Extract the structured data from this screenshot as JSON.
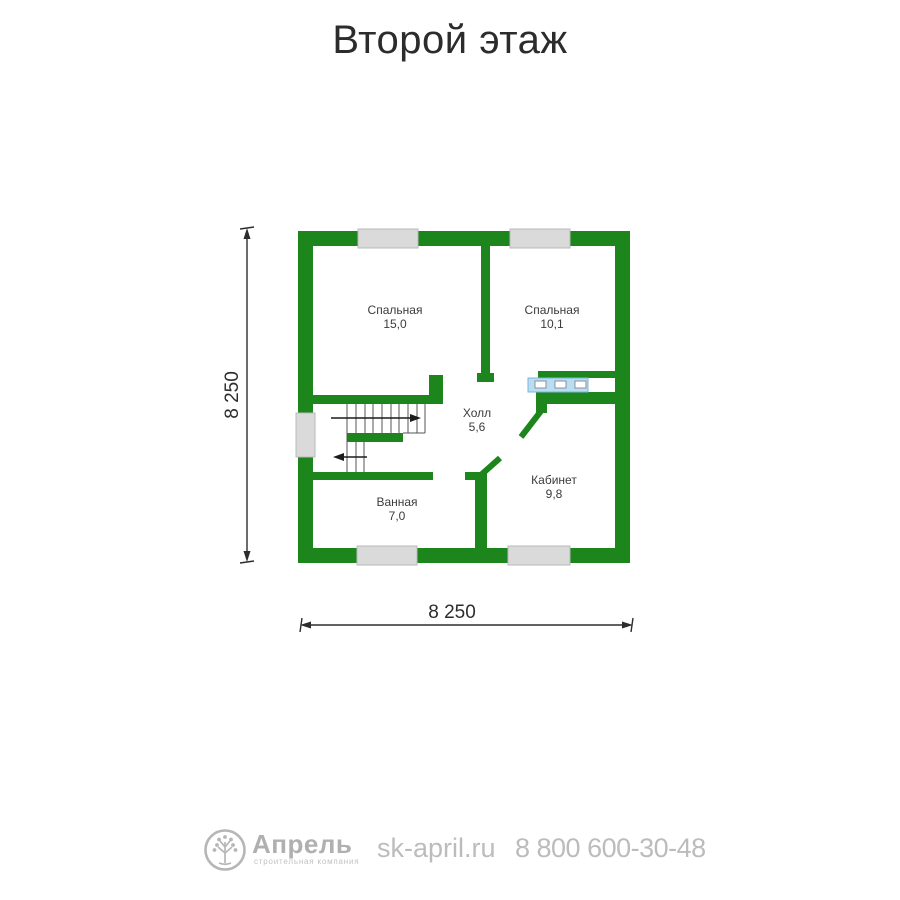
{
  "title": "Второй этаж",
  "plan": {
    "rooms": [
      {
        "name": "Спальная",
        "area": "15,0"
      },
      {
        "name": "Спальная",
        "area": "10,1"
      },
      {
        "name": "Холл",
        "area": "5,6"
      },
      {
        "name": "Кабинет",
        "area": "9,8"
      },
      {
        "name": "Ванная",
        "area": "7,0"
      }
    ],
    "dimensions": {
      "width_label": "8 250",
      "height_label": "8 250"
    }
  },
  "footer": {
    "brand": "Апрель",
    "tagline": "строительная компания",
    "website": "sk-april.ru",
    "phone": "8 800 600-30-48"
  },
  "colors": {
    "wall_green": "#1c851c",
    "window_gray": "#dadada",
    "wardrobe_blue": "#b9ddf3",
    "label_text": "#3b3b3b",
    "dim_text": "#2d2d2d",
    "footer_gray": "#b0b0b0"
  }
}
